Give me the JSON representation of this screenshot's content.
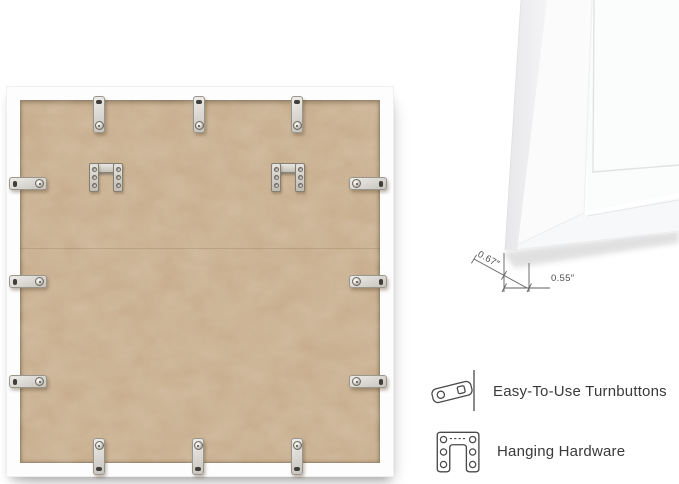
{
  "image": {
    "background_color": "#ffffff"
  },
  "dimension_diagram": {
    "depth_label": "0.67″",
    "face_width_label": "0.55″",
    "line_color": "#5f5f5f"
  },
  "features": [
    {
      "icon": "turnbutton-icon",
      "label": "Easy-To-Use Turnbuttons"
    },
    {
      "icon": "hanging-hardware-icon",
      "label": "Hanging Hardware"
    }
  ],
  "back_panel": {
    "board_color": "#c9ae8d",
    "frame_color": "#fdfdfd",
    "turnbutton_count": 12,
    "sawtooth_hanger_count": 2
  },
  "label_text_color": "#3a3a3a"
}
